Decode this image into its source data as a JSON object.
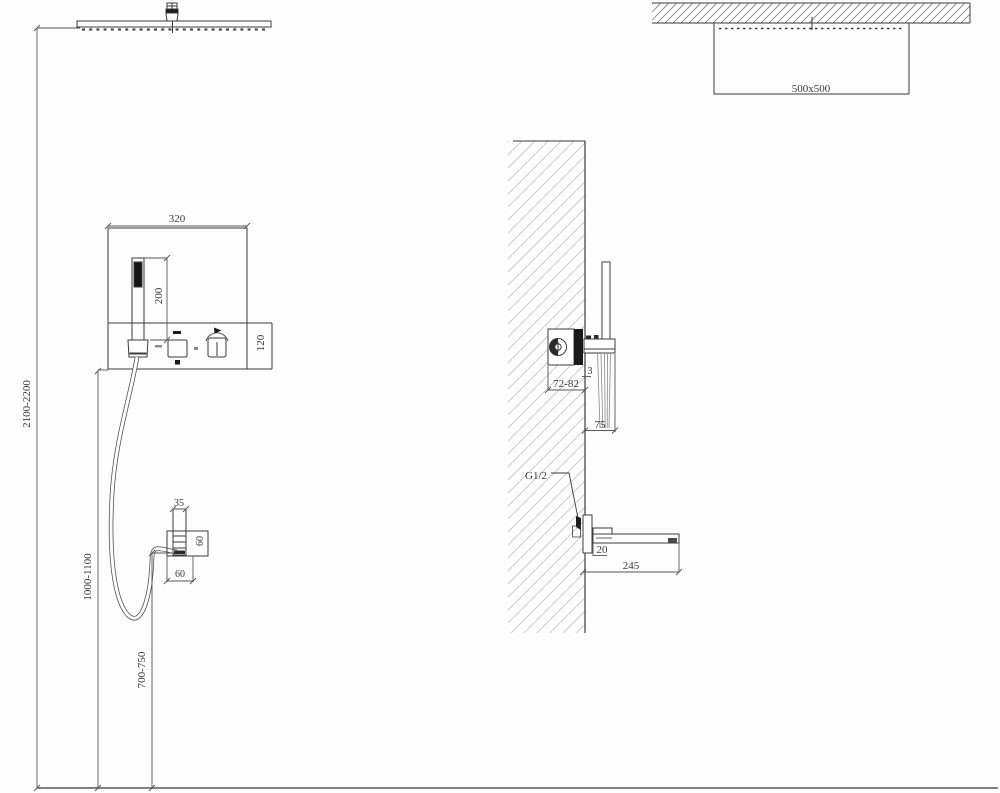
{
  "front_view": {
    "panel_width": "320",
    "handshower_length": "200",
    "valve_plate_height": "120",
    "head_height_range": "2100-2200",
    "valve_height_range": "1000-1100",
    "outlet_height_range": "700-750",
    "outlet_tube_width": "35",
    "outlet_box_height": "60",
    "outlet_box_width": "60"
  },
  "top_view": {
    "head_size": "500x500"
  },
  "side_view": {
    "valve_recess_depth": "72-82",
    "plate_gap": "3",
    "handshower_offset": "75",
    "connection_thread": "G1/2",
    "spout_height": "20",
    "spout_length": "245"
  }
}
